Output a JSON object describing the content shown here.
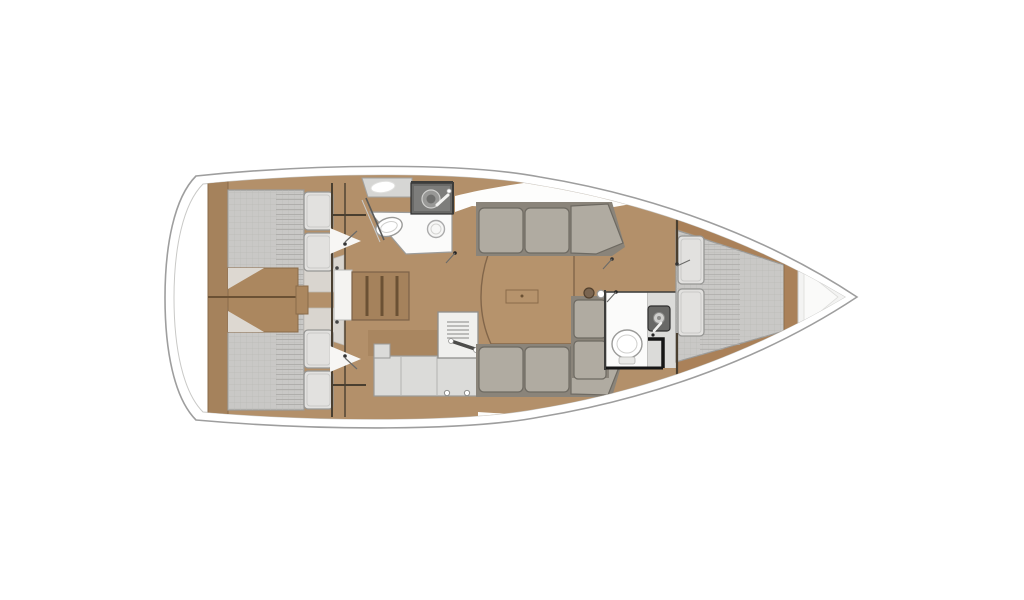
{
  "meta": {
    "type": "sailing-yacht-interior-floor-plan",
    "view": "top-down",
    "orientation": "bow-right-stern-left",
    "canvas": {
      "width": 1024,
      "height": 600
    }
  },
  "colors": {
    "background": "#ffffff",
    "hullStroke": "#9e9e9e",
    "hullInner": "#c9c9c7",
    "wood": "#b3906a",
    "woodDark": "#a5825c",
    "woodBand": "#aa8159",
    "woodEngine": "#ab875f",
    "woodLine": "#6b5134",
    "table": "#b6936c",
    "mattress": "#c9c8c6",
    "pillow": "#e2e1df",
    "sofa": "#b0aba1",
    "sofaDark": "#8a847a",
    "counter": "#dbdbd9",
    "fixture": "#696967",
    "whiteFloor": "#fbfbfa",
    "wall": "#4a3f30",
    "blackWall": "#161616"
  },
  "rooms": [
    {
      "id": "stern-platform",
      "features": [
        "transom"
      ]
    },
    {
      "id": "aft-cabin-port",
      "features": [
        "double-bed",
        "two-pillows"
      ]
    },
    {
      "id": "aft-cabin-starboard",
      "features": [
        "double-bed",
        "two-pillows"
      ]
    },
    {
      "id": "engine-compartment",
      "features": [
        "engine-box"
      ]
    },
    {
      "id": "companionway",
      "features": [
        "steps",
        "landing"
      ]
    },
    {
      "id": "aft-head",
      "features": [
        "toilet",
        "washbasin",
        "vanity-counter-sink",
        "locker"
      ]
    },
    {
      "id": "galley",
      "features": [
        "stove",
        "l-shaped-counter",
        "knobs"
      ]
    },
    {
      "id": "salon",
      "features": [
        "port-sofa",
        "starboard-sofa",
        "side-bench",
        "dining-table",
        "mast-post"
      ]
    },
    {
      "id": "forward-head",
      "features": [
        "toilet",
        "washbasin-counter"
      ]
    },
    {
      "id": "forward-cabin",
      "features": [
        "v-berth-double-bed",
        "two-pillows",
        "shelves"
      ]
    },
    {
      "id": "bow",
      "features": [
        "anchor-locker"
      ]
    }
  ]
}
